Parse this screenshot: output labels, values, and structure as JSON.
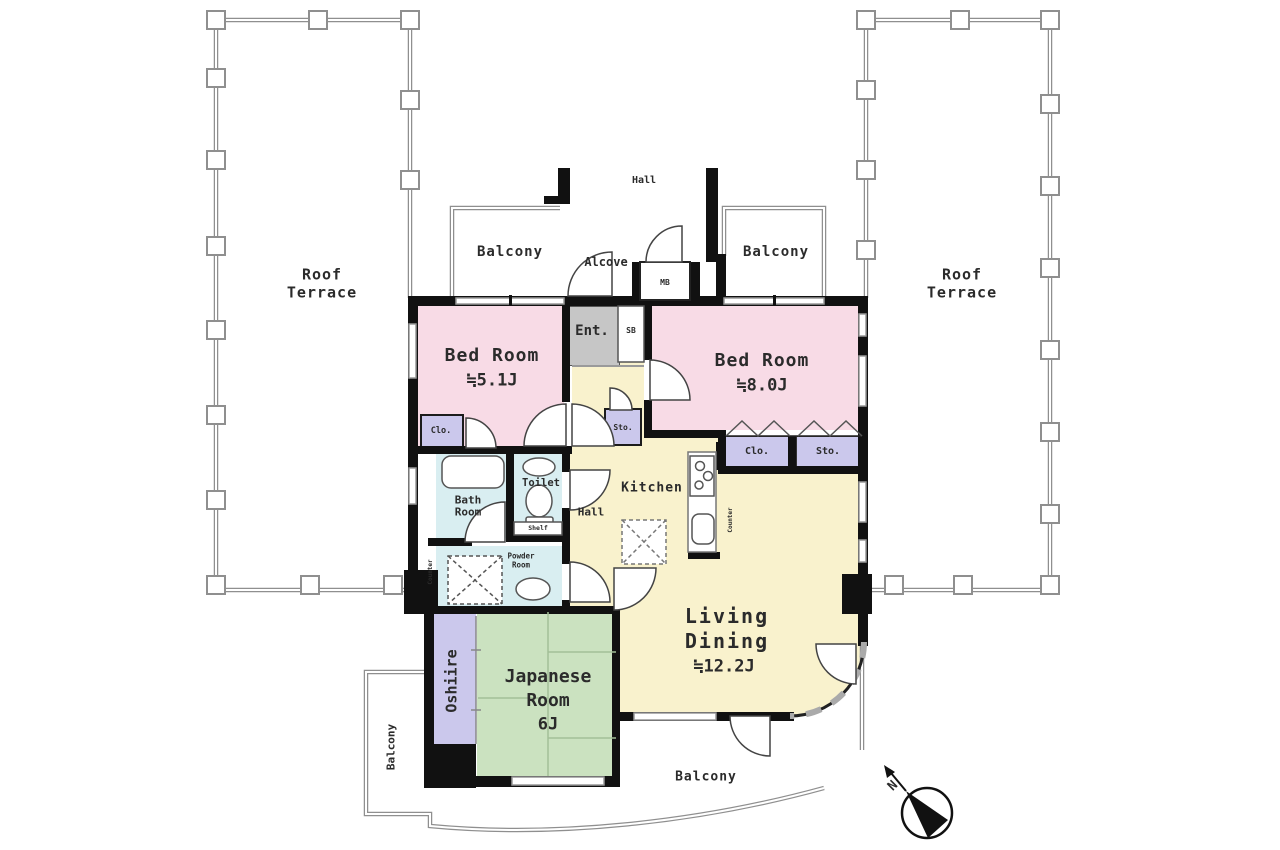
{
  "labels": {
    "roof_terrace": {
      "line1": "Roof",
      "line2": "Terrace"
    },
    "balcony": "Balcony",
    "hall_corridor": "Hall",
    "alcove": "Alcove",
    "meter_box": "MB",
    "entrance": "Ent.",
    "shoe_box": "SB",
    "bedroom_small": {
      "name": "Bed Room",
      "size": "≒5.1J"
    },
    "bedroom_large": {
      "name": "Bed Room",
      "size": "≒8.0J"
    },
    "closet_abbr": "Clo.",
    "storage_abbr": "Sto.",
    "bath": {
      "line1": "Bath",
      "line2": "Room"
    },
    "toilet": "Toilet",
    "shelf": "Shelf",
    "powder": {
      "line1": "Powder",
      "line2": "Room"
    },
    "counter": "Counter",
    "hall_inner": "Hall",
    "kitchen": "Kitchen",
    "living": {
      "line1": "Living",
      "line2": "Dining",
      "size": "≒12.2J"
    },
    "japanese": {
      "line1": "Japanese",
      "line2": "Room",
      "size": "6J"
    },
    "oshiire": "Oshiire",
    "compass_north": "N"
  },
  "colors": {
    "bedroom": "#f8dbe6",
    "living": "#f9f2cd",
    "tatami": "#cbe2c0",
    "storage": "#cbc8ec",
    "wet": "#d9eef1",
    "entrance": "#c6c6c6",
    "wall": "#111111",
    "railing": "#8f8f8f",
    "window": "#999999",
    "fixture": "#555555"
  }
}
